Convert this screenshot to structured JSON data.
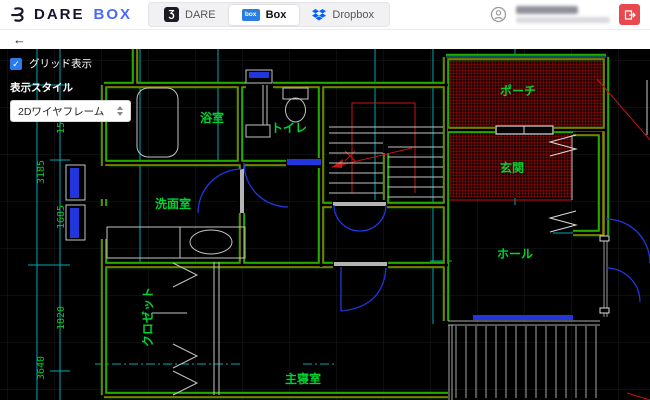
{
  "topbar": {
    "brand": {
      "name": "DARE",
      "suffix": "BOX"
    },
    "box_icon_text": "box",
    "tabs": [
      {
        "label": "DARE",
        "active": false
      },
      {
        "label": "Box",
        "active": true
      },
      {
        "label": "Dropbox",
        "active": false
      }
    ],
    "user": {
      "name_redacted": true
    }
  },
  "subbar": {
    "back": "←"
  },
  "controls": {
    "grid_toggle_label": "グリッド表示",
    "grid_checked": true,
    "check_glyph": "✓",
    "style_label": "表示スタイル",
    "style_value": "2Dワイヤフレーム"
  },
  "plan": {
    "room_labels": {
      "bath": "浴室",
      "toilet": "トイレ",
      "washroom": "洗面室",
      "closet": "クロゼット",
      "master_bedroom": "主寝室",
      "porch": "ポーチ",
      "entrance": "玄関",
      "hall": "ホール"
    },
    "dimensions": {
      "d1": "1500",
      "d2": "3185",
      "d3": "1685",
      "d4": "1820",
      "d5": "3640"
    },
    "colors": {
      "wall": "#00b400",
      "wall_accent": "#8f8f00",
      "guide": "#00a9b4",
      "hatch": "#c40000",
      "door": "#2236dd",
      "label": "#00d232",
      "fixture": "#c4c4c4"
    }
  }
}
